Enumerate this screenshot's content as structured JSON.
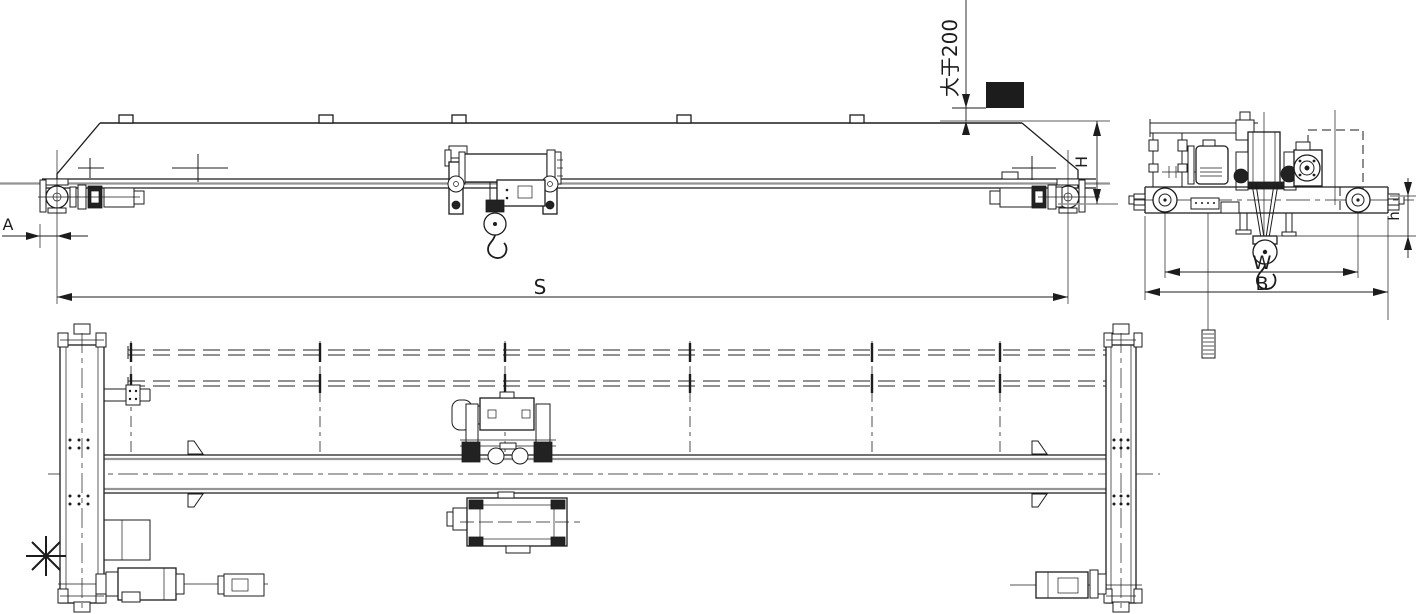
{
  "drawing": {
    "type": "engineering-drawing",
    "labels": {
      "clearance": "大于200",
      "height": "H",
      "span": "S",
      "approach": "A",
      "wheelbase": "W",
      "width": "B",
      "hook": "h"
    },
    "colors": {
      "background": "#ffffff",
      "line": "#1c1c1c",
      "gray_line": "#949494",
      "obstacle_fill": "#111111"
    }
  }
}
